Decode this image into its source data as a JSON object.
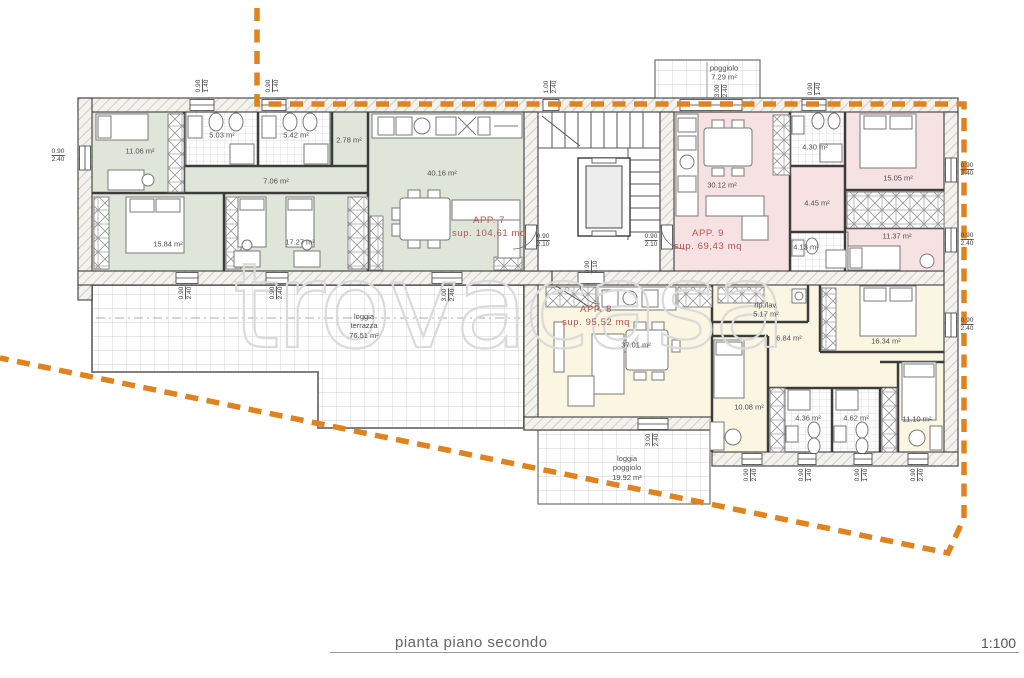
{
  "plan": {
    "title": "pianta piano secondo",
    "scale": "1:100",
    "watermark": "trovacasa"
  },
  "colors": {
    "app7": "#dfe6d9",
    "app8": "#faf6e2",
    "app9": "#f6e1e3",
    "boundary": "#e0831e",
    "red": "#b5524c"
  },
  "apartments": {
    "app7": {
      "name": "APP. 7",
      "area": "sup. 104,61 mq"
    },
    "app8": {
      "name": "APP. 8",
      "area": "sup. 95,52 mq"
    },
    "app9": {
      "name": "APP. 9",
      "area": "sup. 69,43 mq"
    }
  },
  "rooms": {
    "a1106": "11.06 m²",
    "a503": "5.03 m²",
    "a542": "5.42 m²",
    "a278": "2.78 m²",
    "a706": "7.06 m²",
    "a4016": "40.16 m²",
    "a1584": "15.84 m²",
    "a1727": "17.27 m²",
    "a3012": "30.12 m²",
    "a430": "4.30 m²",
    "a1505": "15.05 m²",
    "a445": "4.45 m²",
    "a1137": "11.37 m²",
    "a413": "4.13 m²",
    "a3701": "37.01 m²",
    "ripLav": "rip./lav.\n5.17 m²",
    "a684": "6.84 m²",
    "a1634": "16.34 m²",
    "a1008": "10.08 m²",
    "a436": "4.36 m²",
    "a462": "4.62 m²",
    "a1110": "11.10 m²",
    "poggiolo": "poggiolo\n7.29 m²",
    "loggiaTerrazza": "loggia\nterrazza\n76.51 m²",
    "loggiaPoggiolo": "loggia\npoggiolo\n19.92 m²"
  },
  "dims": {
    "d1": {
      "w": "0.90",
      "h": "1.40"
    },
    "d2": {
      "w": "0.90",
      "h": "1.40"
    },
    "d3": {
      "w": "1.00",
      "h": "2.40"
    },
    "d4": {
      "w": "3.00",
      "h": "2.40"
    },
    "d5": {
      "w": "0.90",
      "h": "1.40"
    },
    "d6": {
      "w": "0.90",
      "h": "2.40"
    },
    "d7": {
      "w": "0.90",
      "h": "2.10"
    },
    "d8": {
      "w": "0.90",
      "h": "2.10"
    },
    "d9": {
      "w": "0.90",
      "h": "2.10"
    },
    "d10": {
      "w": "0.90",
      "h": "2.40"
    },
    "d11": {
      "w": "0.90",
      "h": "2.40"
    },
    "d12": {
      "w": "0.90",
      "h": "2.40"
    },
    "d13": {
      "w": "0.90",
      "h": "2.40"
    },
    "d14": {
      "w": "0.90",
      "h": "2.40"
    },
    "d15": {
      "w": "3.00",
      "h": "2.40"
    },
    "d16": {
      "w": "3.00",
      "h": "2.40"
    },
    "d17": {
      "w": "0.90",
      "h": "2.40"
    },
    "d18": {
      "w": "0.90",
      "h": "1.40"
    },
    "d19": {
      "w": "0.90",
      "h": "1.40"
    },
    "d20": {
      "w": "0.90",
      "h": "2.40"
    }
  }
}
